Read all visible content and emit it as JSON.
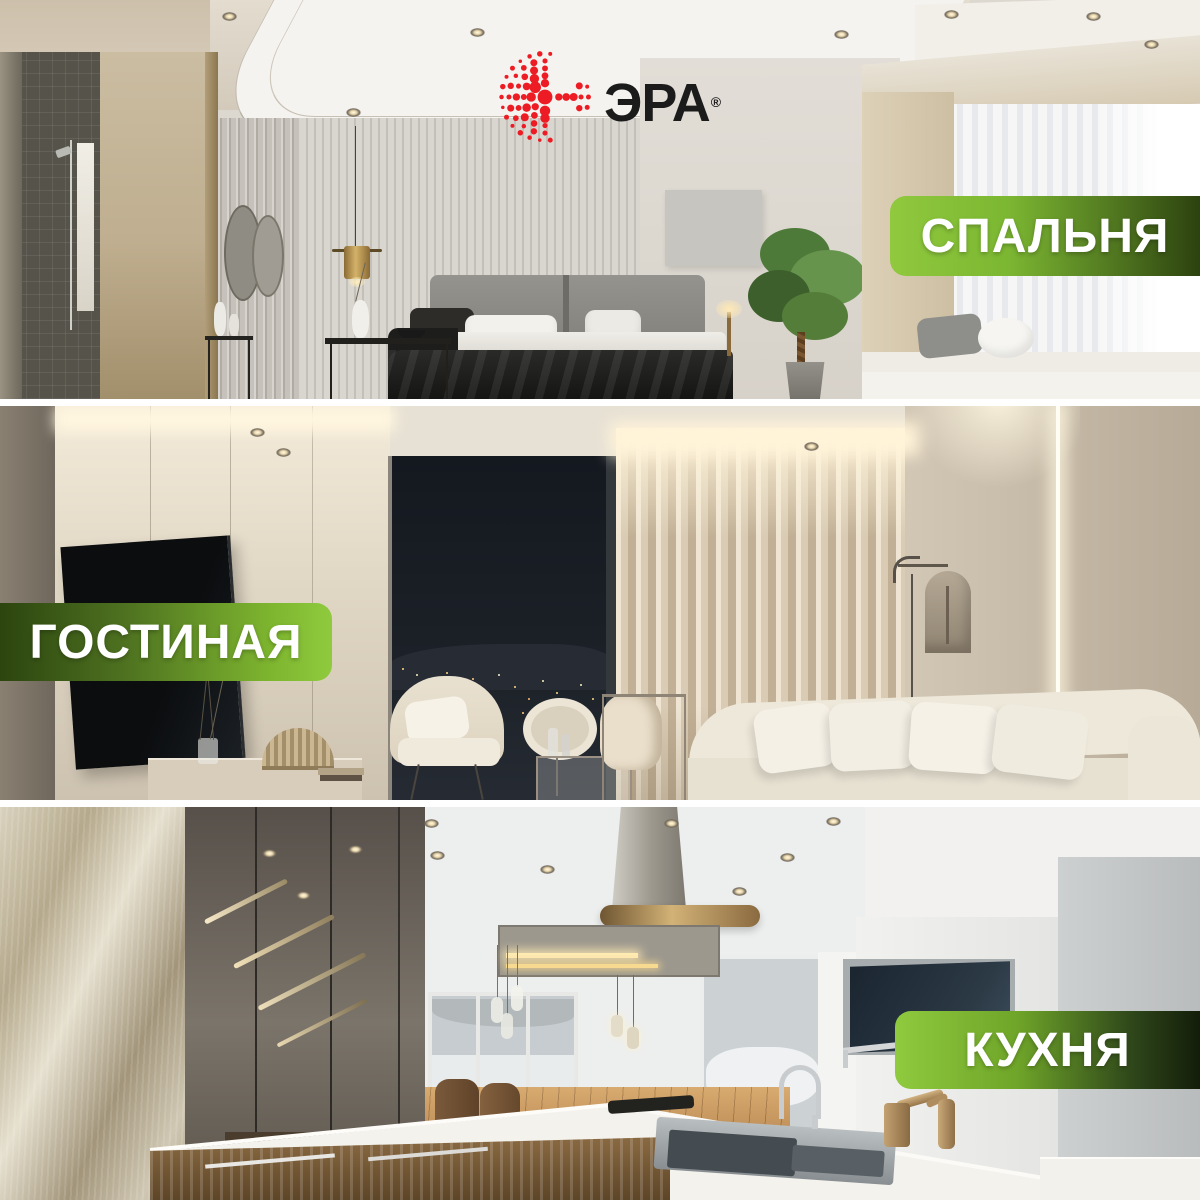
{
  "brand": {
    "name": "ЭРА",
    "registered": "®"
  },
  "colors": {
    "logo_red": "#ED1C24",
    "logo_text": "#1B1B1B",
    "badge_green_light": "#8FCA3E",
    "badge_green_dark": "#17230C",
    "badge_text": "#FFFFFF",
    "separator": "#FFFFFF"
  },
  "rooms": [
    {
      "id": "bedroom",
      "label": "СПАЛЬНЯ",
      "badge_side": "right"
    },
    {
      "id": "living-room",
      "label": "ГОСТИНАЯ",
      "badge_side": "left"
    },
    {
      "id": "kitchen",
      "label": "КУХНЯ",
      "badge_side": "right"
    }
  ]
}
